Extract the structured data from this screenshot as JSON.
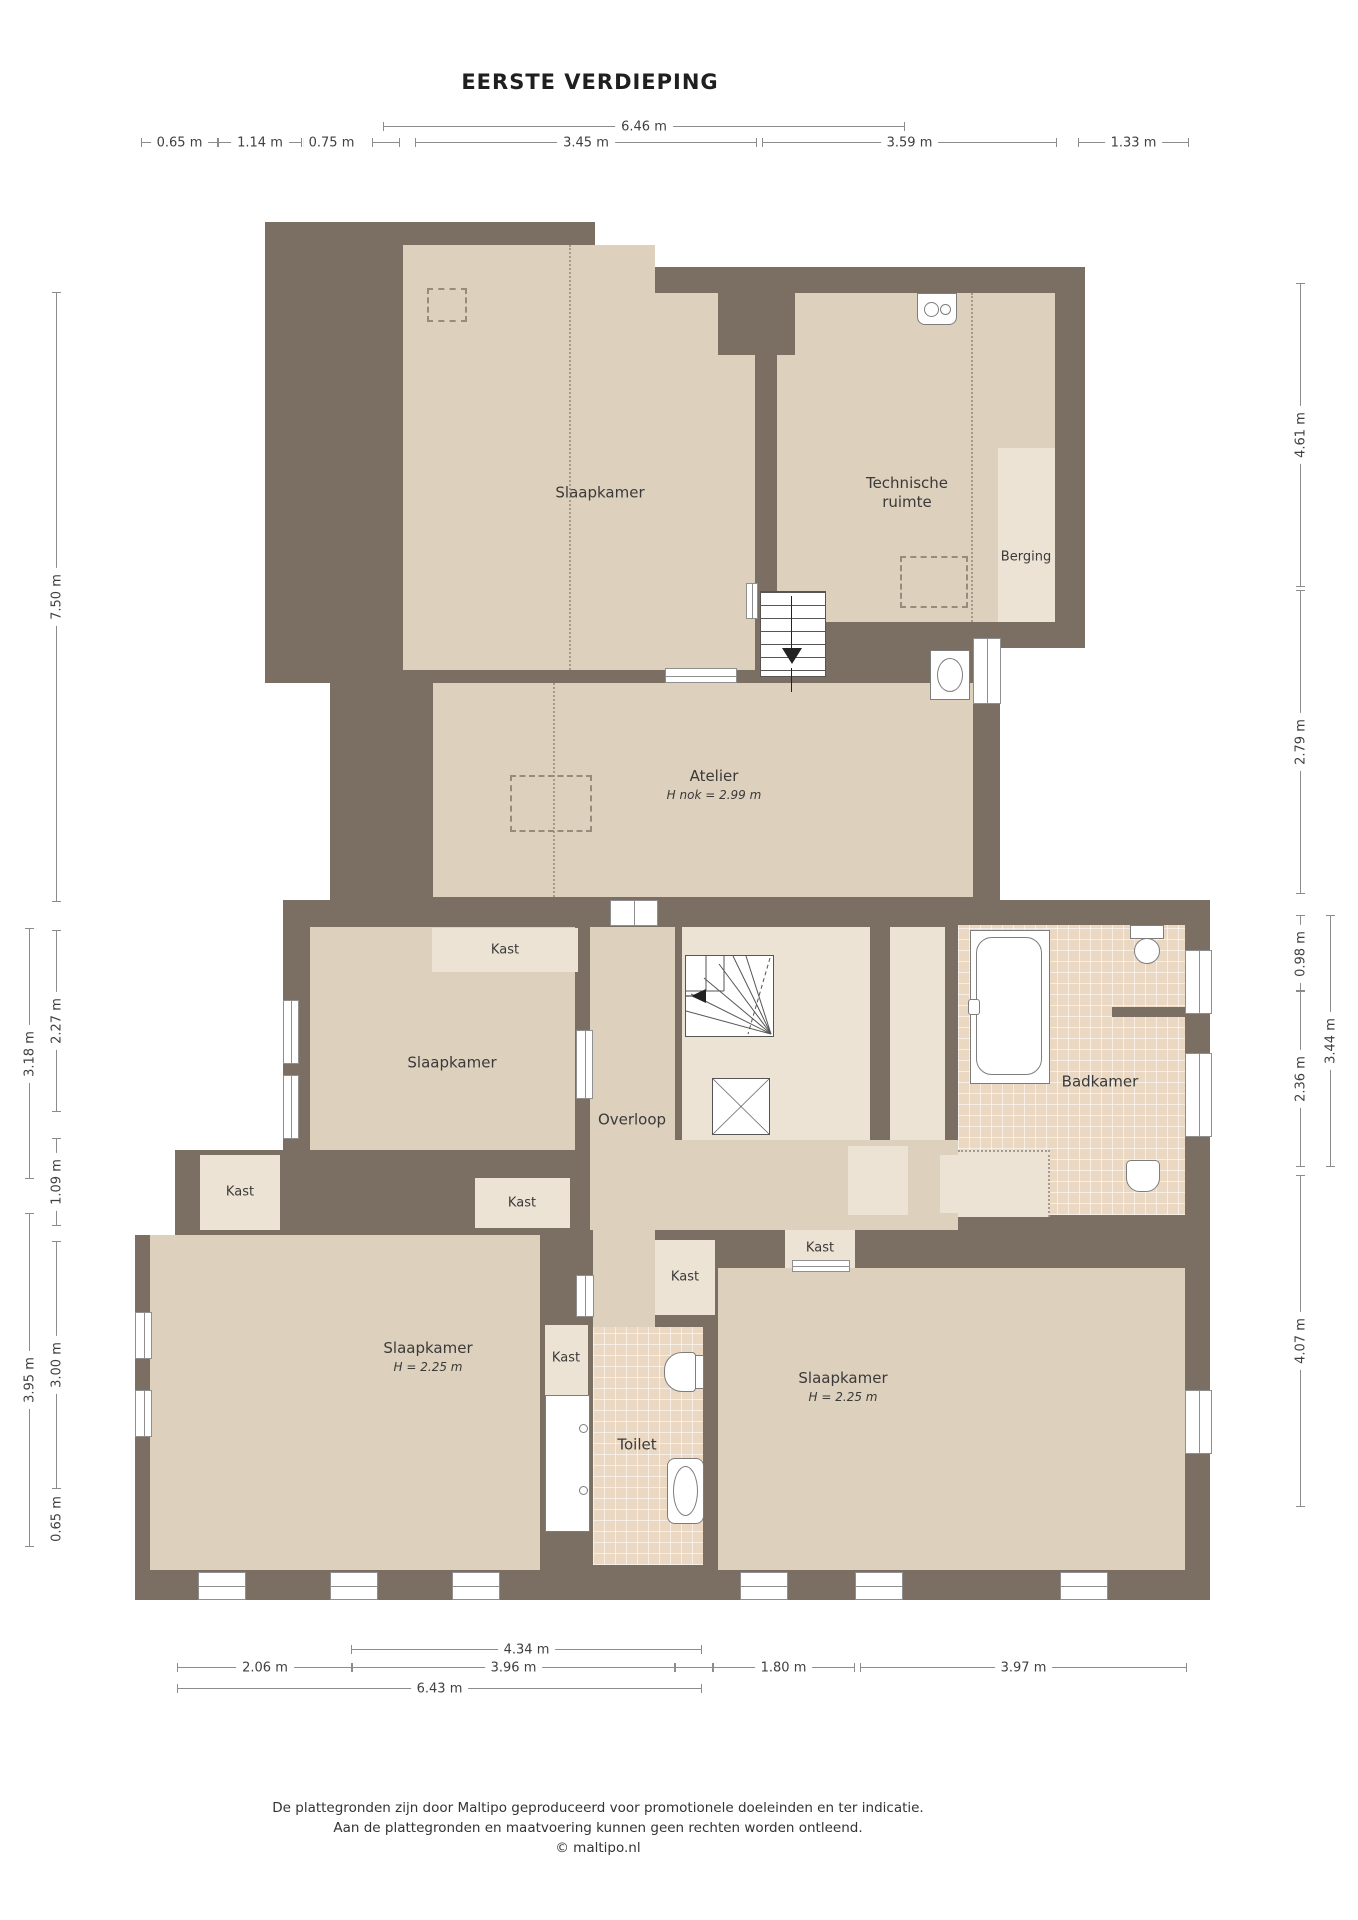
{
  "title": "EERSTE VERDIEPING",
  "rooms": {
    "slaapkamer_top": "Slaapkamer",
    "technische_ruimte_1": "Technische",
    "technische_ruimte_2": "ruimte",
    "berging": "Berging",
    "atelier": "Atelier",
    "atelier_height": "H nok = 2.99 m",
    "slaapkamer_mid": "Slaapkamer",
    "overloop": "Overloop",
    "badkamer": "Badkamer",
    "slaapkamer_left": "Slaapkamer",
    "slaapkamer_left_height": "H = 2.25 m",
    "slaapkamer_right": "Slaapkamer",
    "slaapkamer_right_height": "H = 2.25 m",
    "toilet": "Toilet",
    "kast": "Kast"
  },
  "dimensions": {
    "top": [
      {
        "label": "6.46 m"
      },
      {
        "label": "0.65 m"
      },
      {
        "label": "1.14 m"
      },
      {
        "label": "0.75 m"
      },
      {
        "label": ""
      },
      {
        "label": "3.45 m"
      },
      {
        "label": "3.59 m"
      },
      {
        "label": "1.33 m"
      }
    ],
    "bottom": [
      {
        "label": "4.34 m"
      },
      {
        "label": "2.06 m"
      },
      {
        "label": "3.96 m"
      },
      {
        "label": ""
      },
      {
        "label": "1.80 m"
      },
      {
        "label": "3.97 m"
      },
      {
        "label": "6.43 m"
      }
    ],
    "left": [
      {
        "label": "7.50 m"
      },
      {
        "label": "3.18 m"
      },
      {
        "label": "2.27 m"
      },
      {
        "label": "1.09 m"
      },
      {
        "label": "3.95 m"
      },
      {
        "label": "3.00 m"
      },
      {
        "label": "0.65 m"
      }
    ],
    "right": [
      {
        "label": "4.61 m"
      },
      {
        "label": "2.79 m"
      },
      {
        "label": "0.98 m"
      },
      {
        "label": "3.44 m"
      },
      {
        "label": "2.36 m"
      },
      {
        "label": "4.07 m"
      }
    ]
  },
  "footer": {
    "line1": "De plattegronden zijn door Maltipo geproduceerd voor promotionele doeleinden en ter indicatie.",
    "line2": "Aan de plattegronden en maatvoering kunnen geen rechten worden ontleend.",
    "line3": "© maltipo.nl"
  },
  "colors": {
    "wall": "#7b6e63",
    "floor": "#ddd0bc",
    "light_floor": "#ece3d4",
    "tile_floor": "#ead8c3"
  }
}
